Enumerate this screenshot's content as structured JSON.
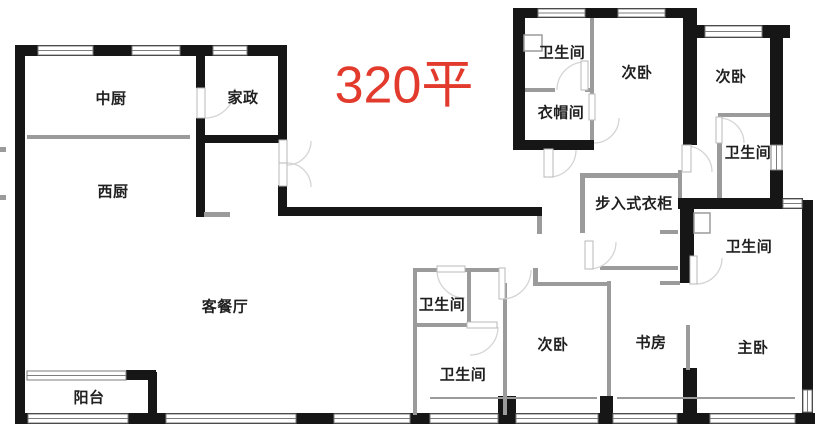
{
  "title": {
    "text": "320平",
    "color": "#e23a2c"
  },
  "rooms": [
    {
      "id": "chinese-kitchen",
      "label": "中厨"
    },
    {
      "id": "housekeeping",
      "label": "家政"
    },
    {
      "id": "western-kitchen",
      "label": "西厨"
    },
    {
      "id": "living-dining",
      "label": "客餐厅"
    },
    {
      "id": "balcony",
      "label": "阳台"
    },
    {
      "id": "bath-top",
      "label": "卫生间"
    },
    {
      "id": "bedroom-top-left",
      "label": "次卧"
    },
    {
      "id": "cloakroom",
      "label": "衣帽间"
    },
    {
      "id": "bedroom-top-right",
      "label": "次卧"
    },
    {
      "id": "bath-upper-right",
      "label": "卫生间"
    },
    {
      "id": "walkin-closet",
      "label": "步入式衣柜"
    },
    {
      "id": "bath-right",
      "label": "卫生间"
    },
    {
      "id": "bath-mid-upper",
      "label": "卫生间"
    },
    {
      "id": "bath-mid-lower",
      "label": "卫生间"
    },
    {
      "id": "bedroom-bottom",
      "label": "次卧"
    },
    {
      "id": "study",
      "label": "书房"
    },
    {
      "id": "master-bedroom",
      "label": "主卧"
    }
  ],
  "colors": {
    "structural_wall": "#161616",
    "partition_wall": "#9b9b9b",
    "door_arc": "#d4d4d4",
    "window_frame": "#7d7d7d"
  }
}
